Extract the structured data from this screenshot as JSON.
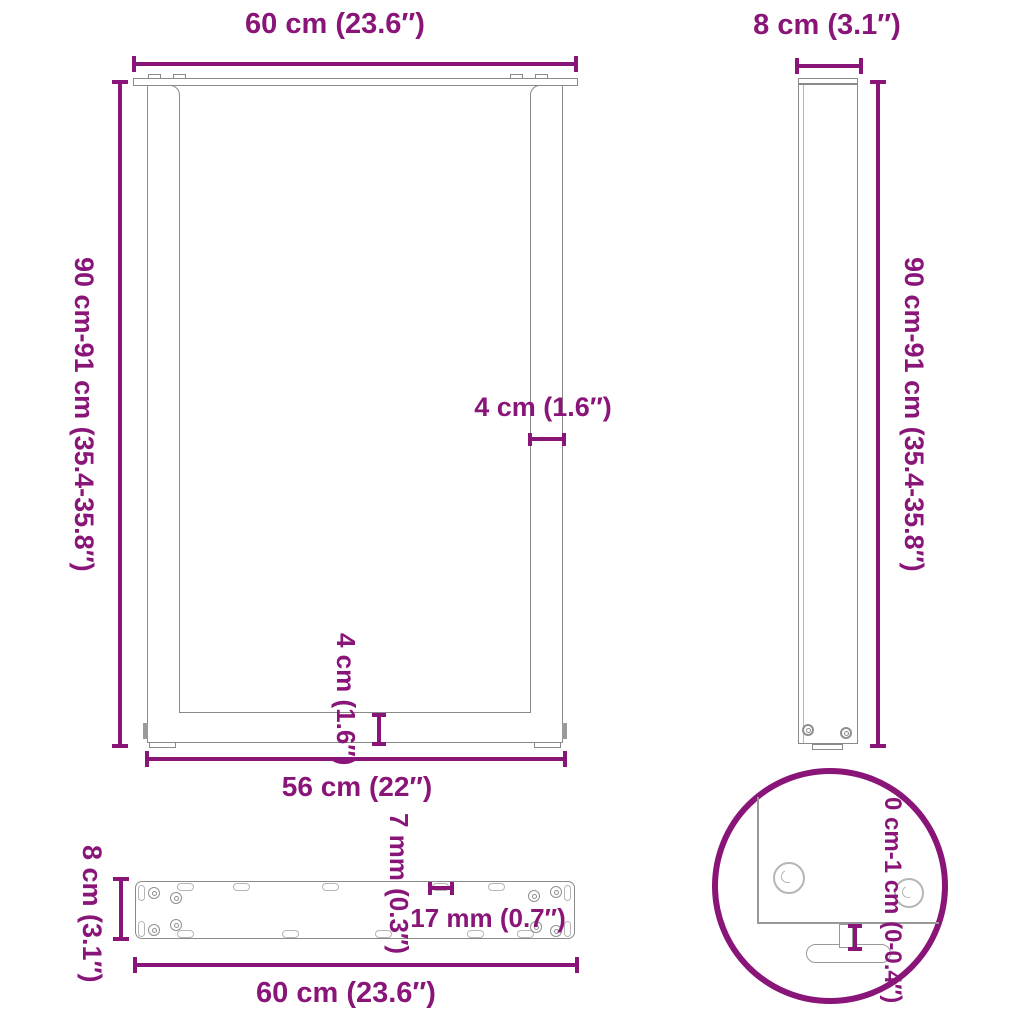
{
  "colors": {
    "accent": "#8A1578",
    "drawing_line": "#8C8C8C"
  },
  "front_view": {
    "top_width_label": "60 cm (23.6″)",
    "height_label": "90 cm-91 cm (35.4-35.8″)",
    "upright_width_label": "4 cm (1.6″)",
    "crossbar_height_label": "4 cm (1.6″)",
    "foot_span_label": "56 cm (22″)"
  },
  "side_view": {
    "depth_label": "8 cm (3.1″)",
    "height_label": "90 cm-91 cm (35.4-35.8″)"
  },
  "plate_view": {
    "depth_label": "8 cm (3.1″)",
    "plate_thickness_label": "7 mm (0.3″)",
    "hole_diameter_label": "17 mm (0.7″)",
    "width_label": "60 cm (23.6″)"
  },
  "detail_view": {
    "adjustable_foot_range_label": "0 cm-1 cm (0-0.4″)"
  }
}
